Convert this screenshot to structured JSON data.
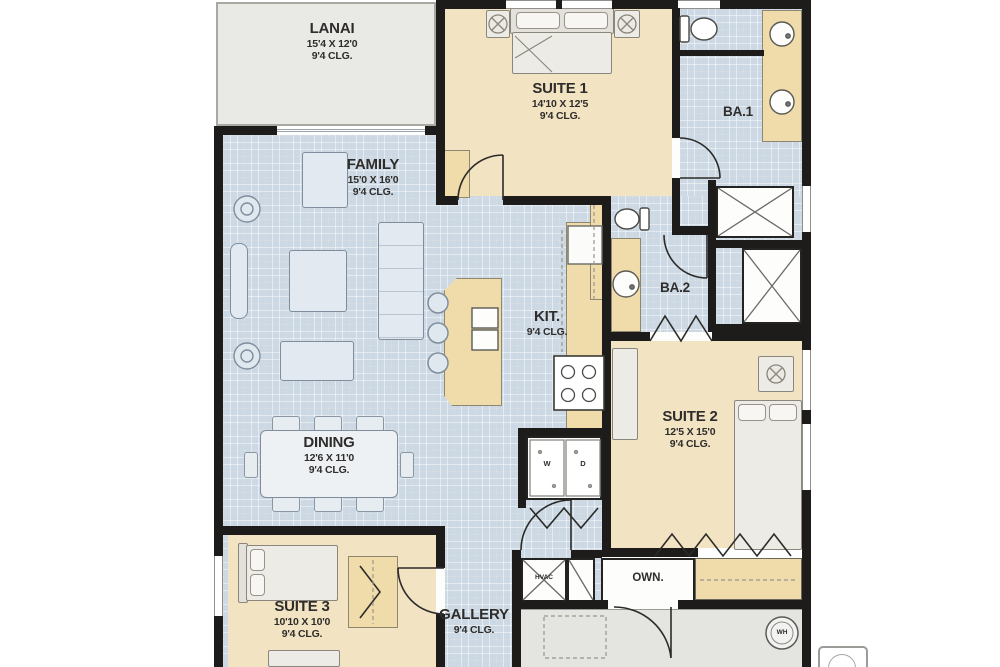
{
  "rooms": {
    "lanai": {
      "name": "LANAI",
      "dims": "15'4 X 12'0",
      "clg": "9'4 CLG."
    },
    "suite1": {
      "name": "SUITE 1",
      "dims": "14'10 X 12'5",
      "clg": "9'4 CLG."
    },
    "ba1": {
      "name": "BA.1"
    },
    "family": {
      "name": "FAMILY",
      "dims": "15'0 X 16'0",
      "clg": "9'4 CLG."
    },
    "kit": {
      "name": "KIT.",
      "clg": "9'4 CLG."
    },
    "ba2": {
      "name": "BA.2"
    },
    "suite2": {
      "name": "SUITE 2",
      "dims": "12'5 X 15'0",
      "clg": "9'4 CLG."
    },
    "dining": {
      "name": "DINING",
      "dims": "12'6 X 11'0",
      "clg": "9'4 CLG."
    },
    "suite3": {
      "name": "SUITE 3",
      "dims": "10'10 X 10'0",
      "clg": "9'4 CLG."
    },
    "gallery": {
      "name": "GALLERY",
      "clg": "9'4 CLG."
    },
    "own": {
      "name": "OWN."
    },
    "hvac": {
      "name": "HVAC"
    },
    "wh": {
      "name": "WH"
    },
    "laundry": {
      "washer": "W",
      "dryer": "D"
    }
  },
  "colors": {
    "tile": "#ccd8e3",
    "carpet": "#f2e3c3",
    "counter": "#f0dcab",
    "wall": "#1d1c1a",
    "lanai": "#e9e9e6",
    "garage": "#e4e4e1",
    "text": "#2e2d2b"
  }
}
